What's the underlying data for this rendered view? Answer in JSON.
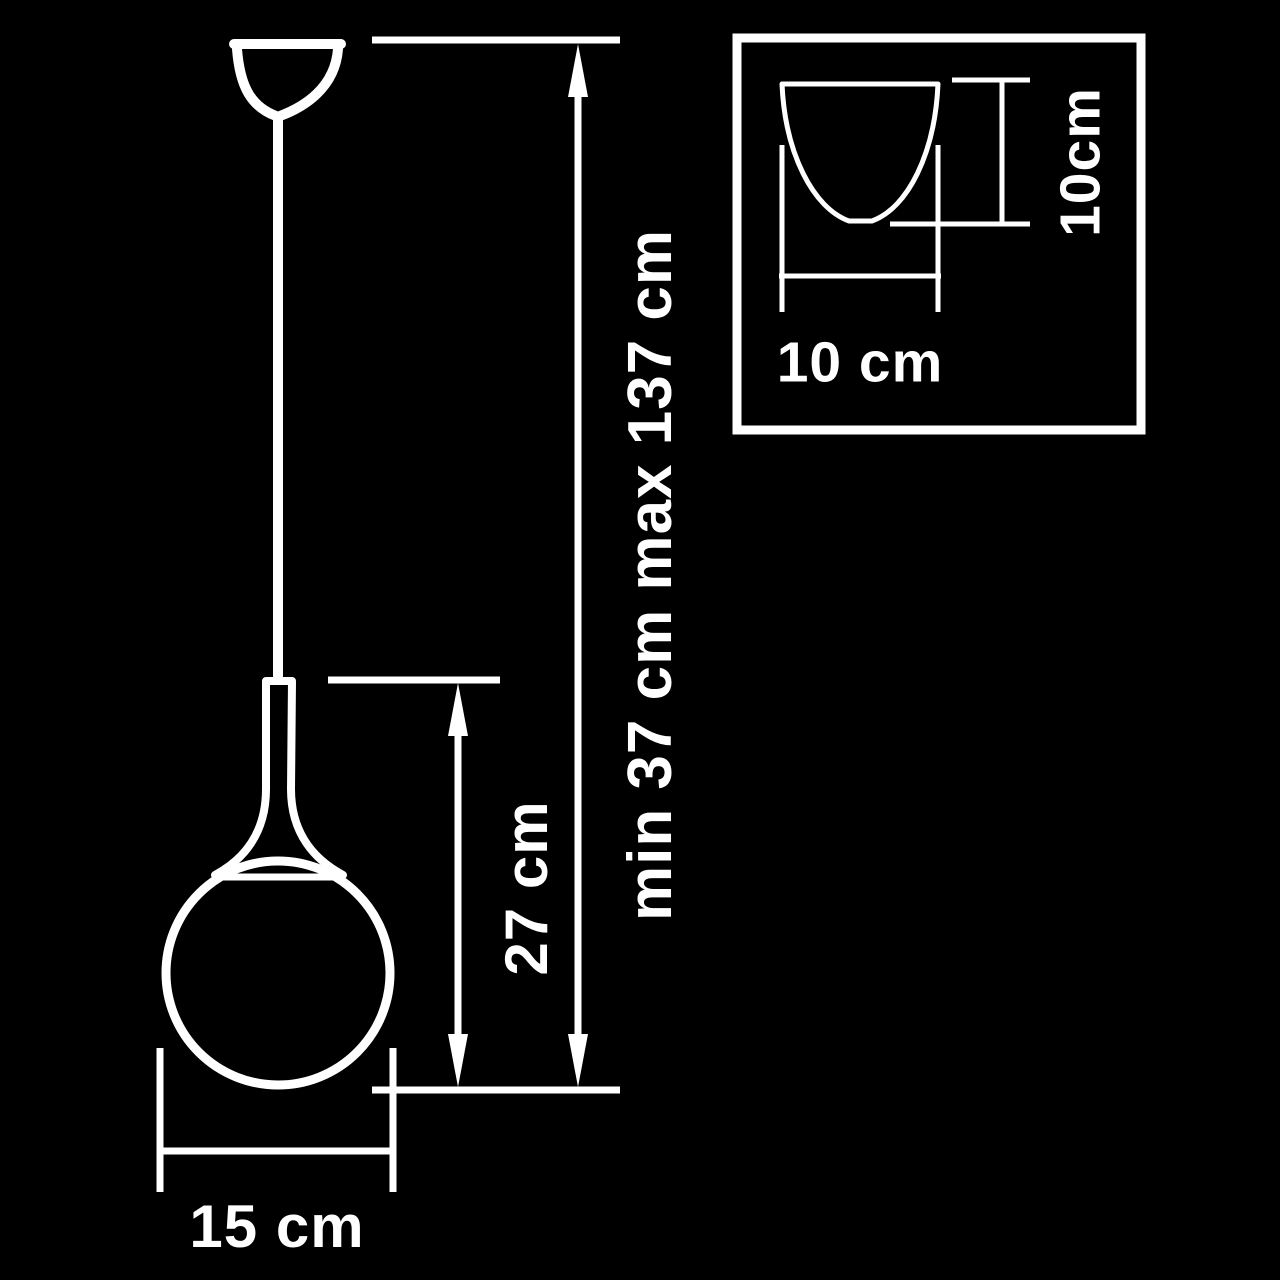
{
  "page": {
    "background_color": "#000000",
    "line_color": "#ffffff",
    "description": "Pendant lamp dimension diagram with canopy detail inset"
  },
  "labels": {
    "overall_height": "min 37 cm max 137 cm",
    "body_height": "27 cm",
    "shade_diameter": "15 cm",
    "inset_canopy_width": "10 cm",
    "inset_canopy_height": "10cm"
  }
}
